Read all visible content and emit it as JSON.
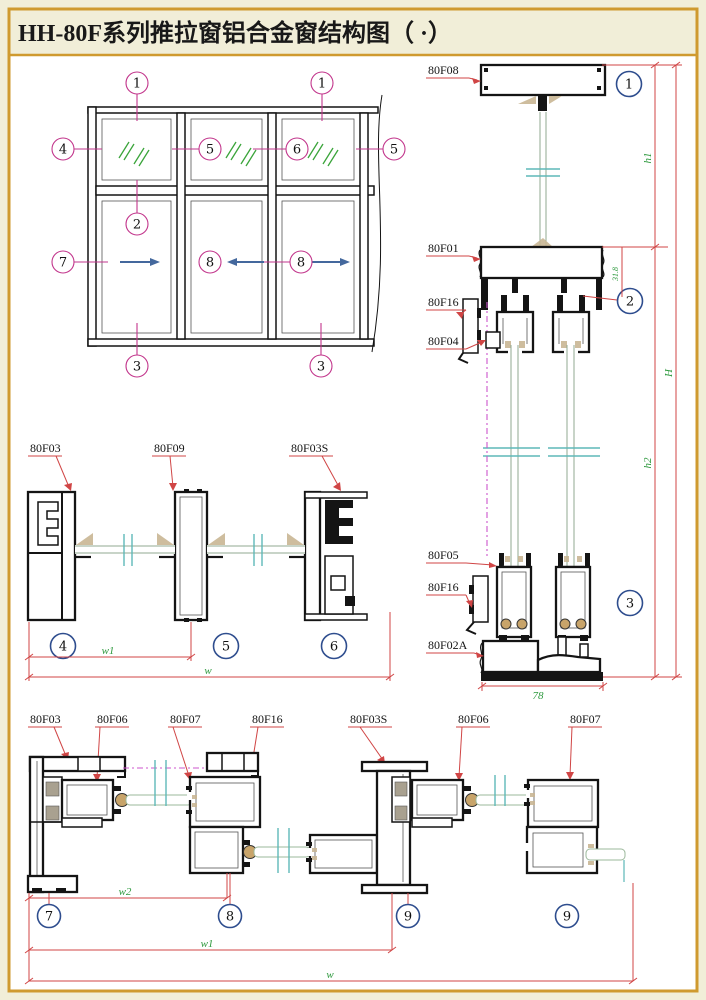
{
  "title": "HH-80F系列推拉窗铝合金窗结构图（ ·）",
  "colors": {
    "page_bg": "#f1eed8",
    "border": "#cf9a2f",
    "drawing_bg": "#ffffff",
    "profile_black": "#141414",
    "callout_magenta": "#c2368c",
    "callout_blue": "#2e4d8e",
    "dimension_red": "#d04545",
    "dimension_green": "#2f9a3f",
    "glass_green": "#90a890",
    "break_cyan": "#5fb8b8",
    "arrow_blue": "#44689d"
  },
  "elevation": {
    "callouts": [
      "1",
      "1",
      "4",
      "5",
      "6",
      "5",
      "2",
      "7",
      "8",
      "8",
      "3",
      "3"
    ]
  },
  "vertical_section": {
    "labels": [
      "80F08",
      "80F01",
      "80F16",
      "80F04",
      "80F05",
      "80F16",
      "80F02A"
    ],
    "callouts": [
      "1",
      "2",
      "3"
    ],
    "dims": {
      "h1": "h1",
      "overlap": "31.8",
      "h2": "h2",
      "H": "H",
      "depth": "78"
    }
  },
  "mid_section": {
    "labels": [
      "80F03",
      "80F09",
      "80F03S"
    ],
    "callouts": [
      "4",
      "5",
      "6"
    ],
    "dims": {
      "w1": "w1",
      "w": "w"
    }
  },
  "bottom_section": {
    "labels": [
      "80F03",
      "80F06",
      "80F07",
      "80F16",
      "80F03S",
      "80F06",
      "80F07"
    ],
    "callouts": [
      "7",
      "8",
      "9",
      "9"
    ],
    "dims": {
      "w2": "w2",
      "w1": "w1",
      "w": "w"
    }
  }
}
